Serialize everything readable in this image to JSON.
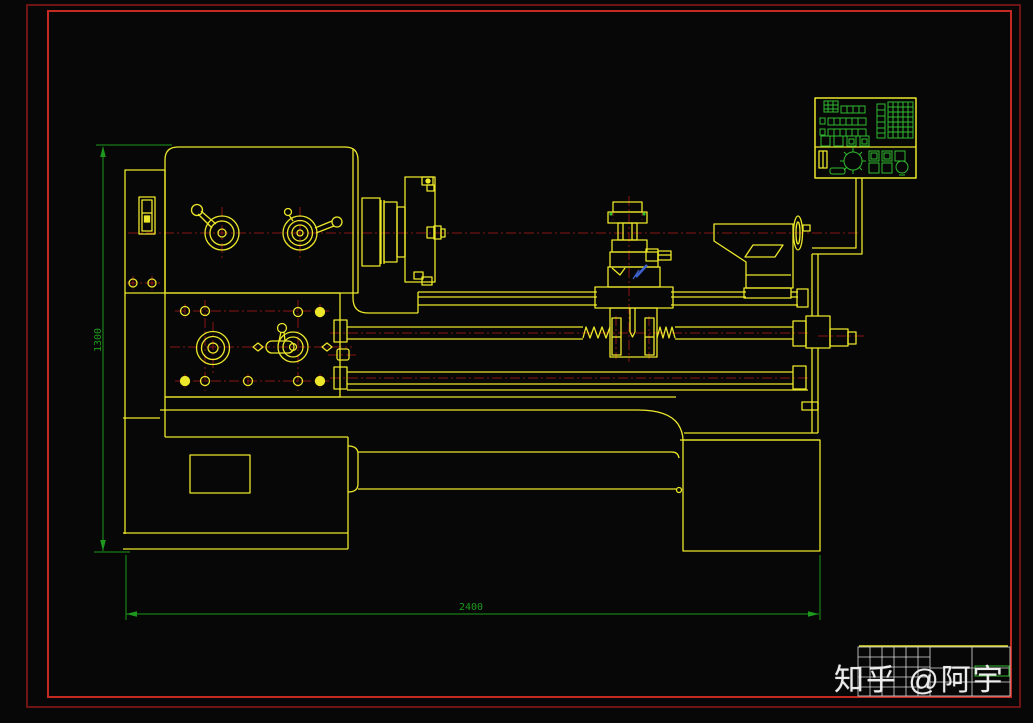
{
  "meta": {
    "description": "CAD engineering drawing (model-space, black background) of a horizontal lathe machine in side elevation, with red drawing frame, yellow machine outlines, dark-red centerlines, green dimensions, a digital readout control panel, and a title block",
    "style": "AutoCAD-like 2D line drawing"
  },
  "dimensions": {
    "height": {
      "label": "1300",
      "orientation": "vertical"
    },
    "length": {
      "label": "2400",
      "orientation": "horizontal"
    }
  },
  "watermark": {
    "text": "知乎 @阿宇"
  },
  "palette": {
    "background": "#070707",
    "frame_outer_red": "#6d1414",
    "frame_inner_red": "#c22a22",
    "outline_yellow": "#ece72b",
    "centerline_red": "#8a1616",
    "dimension_green": "#1d9a1d",
    "panel_green": "#2fbb2f",
    "titleblock_white": "#dcdcdc",
    "section_mark_blue": "#3f63cc",
    "watermark_white": "#f2f2f2"
  },
  "drawing": {
    "subject": "horizontal lathe machine, side view",
    "parts": [
      "headstock",
      "spindle-speed-levers",
      "feed-gearbox",
      "spindle-chuck-faceplate",
      "bed-ways",
      "feed-rod",
      "leadscrew",
      "carriage-toolpost",
      "apron",
      "tailstock",
      "tailstock-handwheel",
      "digital-readout-panel",
      "panel-support-arm",
      "left-base-cabinet",
      "right-base-cabinet",
      "chip-tray",
      "title-block"
    ]
  }
}
